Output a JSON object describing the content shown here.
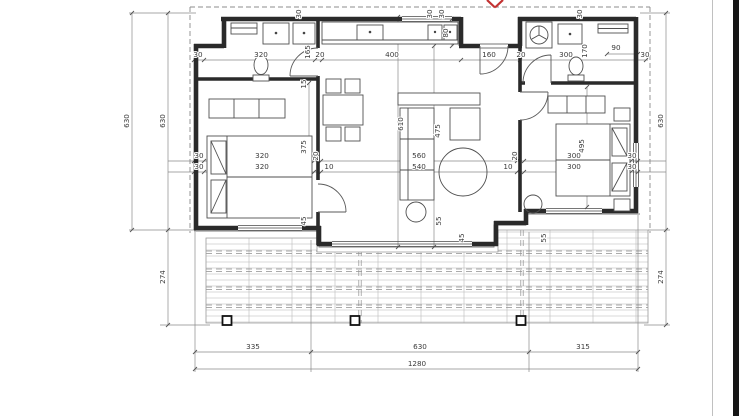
{
  "colors": {
    "wall": "#2a2a2a",
    "dim": "#8a8a8a",
    "label": "#3a3a3a",
    "deck": "#9a9a9a",
    "red": "#c33232",
    "strip": "#161616",
    "pborder": "#c0c0c0"
  },
  "marker": {
    "type": "red-cross-marker"
  },
  "dimension_labels": [
    {
      "t": "630",
      "x": 129,
      "y": 121,
      "r": -90,
      "name": "dim-house-depth-left-outer"
    },
    {
      "t": "630",
      "x": 165,
      "y": 121,
      "r": -90,
      "name": "dim-house-depth-left-inner"
    },
    {
      "t": "274",
      "x": 165,
      "y": 277,
      "r": -90,
      "name": "dim-terrace-depth-left"
    },
    {
      "t": "630",
      "x": 663,
      "y": 121,
      "r": -90,
      "name": "dim-house-depth-right"
    },
    {
      "t": "274",
      "x": 663,
      "y": 277,
      "r": -90,
      "name": "dim-terrace-depth-right"
    },
    {
      "t": "335",
      "x": 253,
      "y": 349,
      "name": "dim-bottom-335"
    },
    {
      "t": "630",
      "x": 420,
      "y": 349,
      "name": "dim-bottom-630"
    },
    {
      "t": "315",
      "x": 583,
      "y": 349,
      "name": "dim-bottom-315"
    },
    {
      "t": "1280",
      "x": 417,
      "y": 366,
      "name": "dim-total-width"
    },
    {
      "t": "30",
      "x": 198,
      "y": 57
    },
    {
      "t": "320",
      "x": 261,
      "y": 57,
      "name": "dim-bathroom-width"
    },
    {
      "t": "165",
      "x": 310,
      "y": 52,
      "r": -90
    },
    {
      "t": "20",
      "x": 320,
      "y": 57
    },
    {
      "t": "400",
      "x": 392,
      "y": 57,
      "name": "dim-kitchen-width"
    },
    {
      "t": "80",
      "x": 448,
      "y": 33,
      "r": -90
    },
    {
      "t": "160",
      "x": 489,
      "y": 57,
      "name": "dim-entrance-width"
    },
    {
      "t": "20",
      "x": 521,
      "y": 57
    },
    {
      "t": "300",
      "x": 566,
      "y": 57,
      "name": "dim-utility-width"
    },
    {
      "t": "170",
      "x": 587,
      "y": 51,
      "r": -90
    },
    {
      "t": "90",
      "x": 616,
      "y": 50
    },
    {
      "t": "30",
      "x": 645,
      "y": 57
    },
    {
      "t": "30",
      "x": 301,
      "y": 14,
      "r": -90
    },
    {
      "t": "30",
      "x": 432,
      "y": 14,
      "r": -90
    },
    {
      "t": "30",
      "x": 444,
      "y": 14,
      "r": -90
    },
    {
      "t": "30",
      "x": 582,
      "y": 14,
      "r": -90
    },
    {
      "t": "30",
      "x": 199,
      "y": 158
    },
    {
      "t": "320",
      "x": 262,
      "y": 158,
      "name": "dim-bedroom-left-width"
    },
    {
      "t": "20",
      "x": 318,
      "y": 156,
      "r": -90
    },
    {
      "t": "560",
      "x": 419,
      "y": 158,
      "name": "dim-living-width"
    },
    {
      "t": "20",
      "x": 517,
      "y": 156,
      "r": -90
    },
    {
      "t": "300",
      "x": 574,
      "y": 158,
      "name": "dim-bedroom-right-width"
    },
    {
      "t": "30",
      "x": 632,
      "y": 158
    },
    {
      "t": "30",
      "x": 199,
      "y": 169
    },
    {
      "t": "320",
      "x": 262,
      "y": 169
    },
    {
      "t": "10",
      "x": 329,
      "y": 169
    },
    {
      "t": "540",
      "x": 419,
      "y": 169
    },
    {
      "t": "10",
      "x": 508,
      "y": 169
    },
    {
      "t": "300",
      "x": 574,
      "y": 169
    },
    {
      "t": "30",
      "x": 632,
      "y": 169
    },
    {
      "t": "375",
      "x": 306,
      "y": 147,
      "r": -90
    },
    {
      "t": "495",
      "x": 584,
      "y": 146,
      "r": -90
    },
    {
      "t": "610",
      "x": 403,
      "y": 124,
      "r": -90
    },
    {
      "t": "475",
      "x": 440,
      "y": 131,
      "r": -90
    },
    {
      "t": "15",
      "x": 306,
      "y": 84,
      "r": -90
    },
    {
      "t": "45",
      "x": 306,
      "y": 221,
      "r": -90
    },
    {
      "t": "55",
      "x": 441,
      "y": 221,
      "r": -90
    },
    {
      "t": "45",
      "x": 464,
      "y": 238,
      "r": -90
    },
    {
      "t": "55",
      "x": 546,
      "y": 238,
      "r": -90
    }
  ]
}
